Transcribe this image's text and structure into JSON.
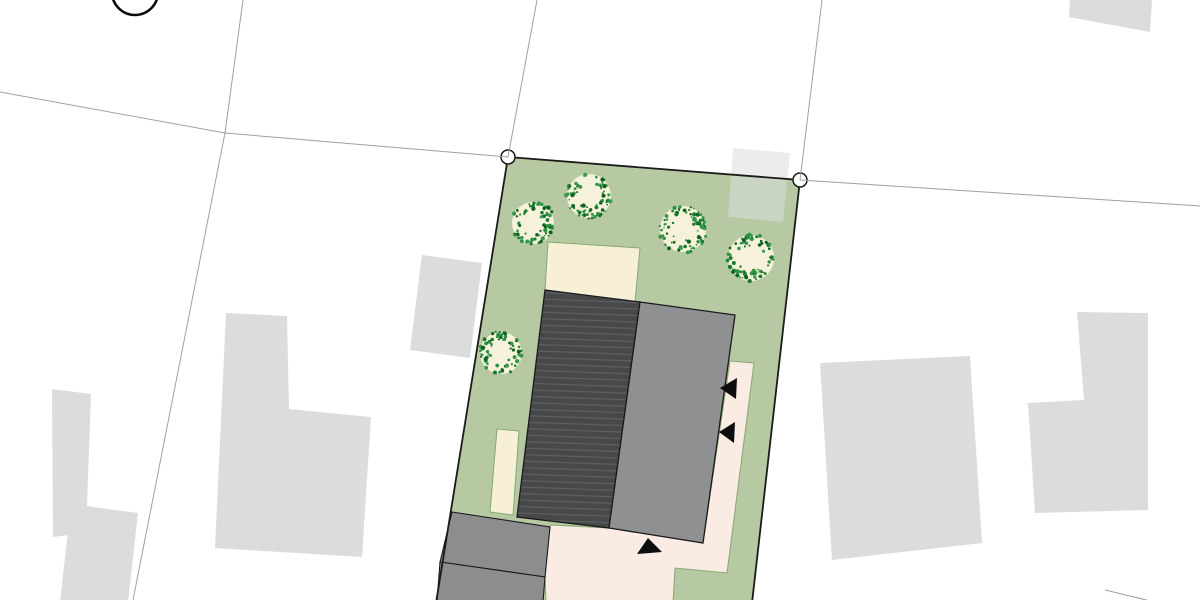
{
  "canvas": {
    "width": 1200,
    "height": 600,
    "background": "#ffffff"
  },
  "colors": {
    "lawn_green": "#b6c9a2",
    "path_pink": "#fbece3",
    "terrace_cream": "#f8f0d6",
    "roof_dark": "#47484a",
    "roof_hatch_line": "#5f6264",
    "building_gray": "#8e9091",
    "garage_gray": "#8c8d8e",
    "neighbor_gray": "#dbdcdc",
    "tree_canopy_cream": "#f6f1da",
    "tree_speckle_greens": [
      "#1a7a2e",
      "#2e9242",
      "#0f6322",
      "#35994a"
    ],
    "boundary_black": "#1a1a1a",
    "parcel_line_gray": "#a0a0a0",
    "path_outline_green": "#87a873",
    "marker_black": "#0d0d0d"
  },
  "site_plan": {
    "plot_outline": [
      [
        508,
        157
      ],
      [
        800,
        180
      ],
      [
        752,
        603
      ],
      [
        436,
        603
      ]
    ],
    "survey_markers": [
      {
        "x": 508,
        "y": 157,
        "r": 7
      },
      {
        "x": 800,
        "y": 180,
        "r": 7
      }
    ],
    "partial_circle_symbol": {
      "x": 135,
      "y": -8,
      "r": 23,
      "stroke_width": 2.6
    },
    "parcel_lines": [
      [
        [
          0,
          92
        ],
        [
          225,
          133
        ]
      ],
      [
        [
          225,
          133
        ],
        [
          508,
          157
        ]
      ],
      [
        [
          243,
          0
        ],
        [
          225,
          133
        ]
      ],
      [
        [
          225,
          133
        ],
        [
          133,
          600
        ]
      ],
      [
        [
          537,
          0
        ],
        [
          508,
          157
        ]
      ],
      [
        [
          822,
          0
        ],
        [
          800,
          180
        ]
      ],
      [
        [
          800,
          180
        ],
        [
          1200,
          206
        ]
      ],
      [
        [
          1105,
          590
        ],
        [
          1200,
          613
        ]
      ]
    ],
    "trees": [
      {
        "x": 533,
        "y": 223,
        "r": 21
      },
      {
        "x": 589,
        "y": 196,
        "r": 22
      },
      {
        "x": 683,
        "y": 229,
        "r": 23
      },
      {
        "x": 751,
        "y": 258,
        "r": 23
      },
      {
        "x": 501,
        "y": 353,
        "r": 21
      }
    ],
    "terraces": [
      {
        "points": [
          [
            548,
            242
          ],
          [
            640,
            248
          ],
          [
            635,
            302
          ],
          [
            545,
            290
          ]
        ]
      },
      {
        "points": [
          [
            497,
            429
          ],
          [
            519,
            431
          ],
          [
            513,
            515
          ],
          [
            490,
            512
          ]
        ]
      }
    ],
    "path_polygon": [
      [
        730,
        361
      ],
      [
        754,
        363
      ],
      [
        727,
        573
      ],
      [
        675,
        568
      ],
      [
        673,
        602
      ],
      [
        546,
        602
      ],
      [
        545,
        577
      ],
      [
        550,
        525
      ],
      [
        609,
        528
      ],
      [
        703,
        543
      ]
    ],
    "garages": [
      {
        "points": [
          [
            452,
            512
          ],
          [
            550,
            527
          ],
          [
            545,
            577
          ],
          [
            440,
            562
          ]
        ]
      },
      {
        "points": [
          [
            440,
            562
          ],
          [
            545,
            577
          ],
          [
            543,
            602
          ],
          [
            437,
            602
          ]
        ]
      }
    ],
    "main_house_roof": [
      [
        545,
        290
      ],
      [
        640,
        302
      ],
      [
        609,
        528
      ],
      [
        517,
        517
      ]
    ],
    "flat_roof_building": [
      [
        640,
        302
      ],
      [
        735,
        315
      ],
      [
        703,
        543
      ],
      [
        609,
        528
      ]
    ],
    "entrance_arrows": [
      [
        [
          720,
          388
        ],
        [
          737,
          378
        ],
        [
          736,
          399
        ]
      ],
      [
        [
          719,
          432
        ],
        [
          735,
          422
        ],
        [
          734,
          443
        ]
      ],
      [
        [
          648,
          538
        ],
        [
          637,
          554
        ],
        [
          662,
          552
        ]
      ]
    ],
    "neighbor_buildings": [
      {
        "name": "shed-over-north-boundary",
        "opacity": 0.55,
        "points": [
          [
            733,
            148
          ],
          [
            790,
            153
          ],
          [
            783,
            222
          ],
          [
            728,
            217
          ]
        ]
      },
      {
        "name": "shed-west-of-plot",
        "opacity": 1,
        "points": [
          [
            422,
            255
          ],
          [
            482,
            263
          ],
          [
            470,
            358
          ],
          [
            410,
            350
          ]
        ]
      },
      {
        "name": "west-l-shaped-house",
        "opacity": 1,
        "points": [
          [
            226,
            313
          ],
          [
            287,
            316
          ],
          [
            289,
            409
          ],
          [
            371,
            417
          ],
          [
            362,
            557
          ],
          [
            215,
            548
          ]
        ]
      },
      {
        "name": "far-west-narrow-house",
        "opacity": 1,
        "points": [
          [
            52,
            389
          ],
          [
            91,
            394
          ],
          [
            86,
            533
          ],
          [
            53,
            537
          ]
        ]
      },
      {
        "name": "southwest-house",
        "opacity": 1,
        "points": [
          [
            71,
            504
          ],
          [
            138,
            513
          ],
          [
            128,
            602
          ],
          [
            60,
            602
          ]
        ]
      },
      {
        "name": "east-house",
        "opacity": 1,
        "points": [
          [
            820,
            363
          ],
          [
            970,
            356
          ],
          [
            982,
            543
          ],
          [
            832,
            560
          ]
        ]
      },
      {
        "name": "far-east-l-shaped-house",
        "opacity": 1,
        "points": [
          [
            1077,
            312
          ],
          [
            1148,
            313
          ],
          [
            1148,
            510
          ],
          [
            1035,
            513
          ],
          [
            1028,
            403
          ],
          [
            1084,
            400
          ]
        ]
      },
      {
        "name": "northeast-corner-house",
        "opacity": 1,
        "points": [
          [
            1070,
            0
          ],
          [
            1152,
            0
          ],
          [
            1150,
            32
          ],
          [
            1069,
            17
          ]
        ]
      }
    ]
  }
}
